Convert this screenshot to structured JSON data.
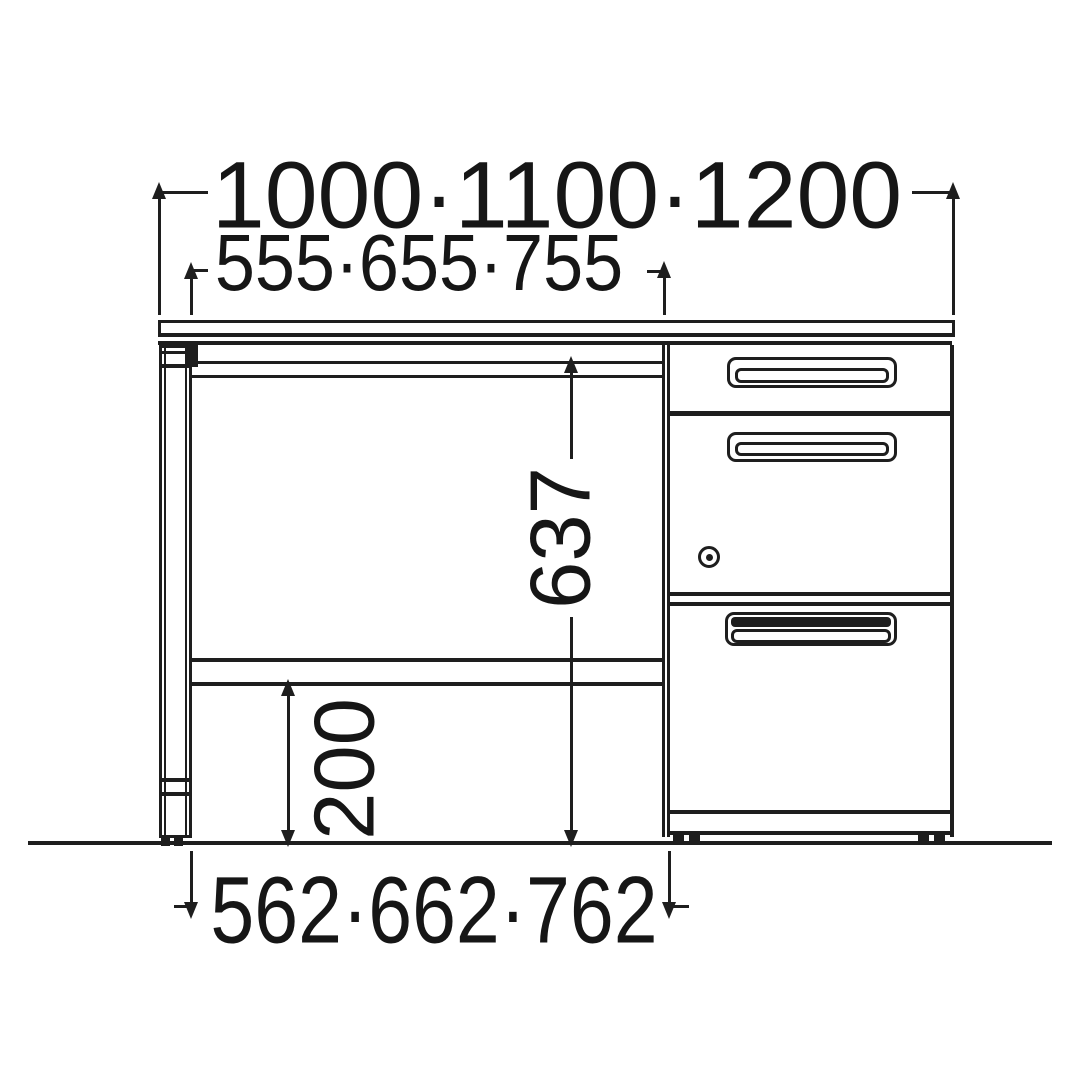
{
  "drawing": {
    "kind": "furniture-dimension-diagram",
    "view": "front elevation of desk with left panel leg and 3-drawer pedestal",
    "units": "mm",
    "colors": {
      "line": "#1e1e1e",
      "background": "#ffffff"
    },
    "dimensions": {
      "overall_width": {
        "label": "1000·1100·1200",
        "values": [
          1000,
          1100,
          1200
        ],
        "orientation": "horizontal"
      },
      "top_inner_width": {
        "label": "555·655·755",
        "values": [
          555,
          655,
          755
        ],
        "orientation": "horizontal"
      },
      "knee_height": {
        "label": "637",
        "values": [
          637
        ],
        "orientation": "vertical"
      },
      "floor_clearance": {
        "label": "200",
        "values": [
          200
        ],
        "orientation": "vertical"
      },
      "bottom_inner_width": {
        "label": "562·662·762",
        "values": [
          562,
          662,
          762
        ],
        "orientation": "horizontal"
      }
    },
    "parts": {
      "pedestal_drawers": 3,
      "lock": "cylinder lock on middle drawer",
      "icons": [
        "lock-icon"
      ]
    }
  }
}
